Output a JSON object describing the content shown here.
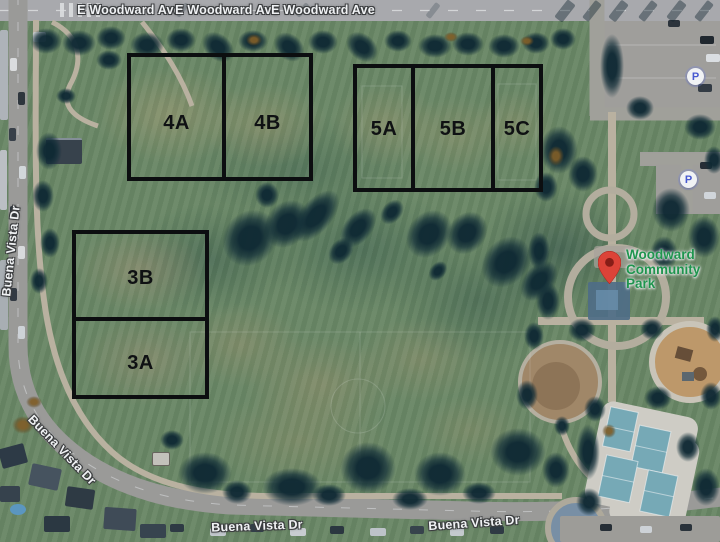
{
  "map": {
    "description": "Satellite map of Woodward Community Park with labeled sports fields"
  },
  "streets": {
    "e_woodward": [
      "E Woodward Ave",
      "E Woodward Ave",
      "E Woodward Ave"
    ],
    "buena_vista": [
      "Buena Vista Dr",
      "Buena Vista Dr",
      "Buena Vista Dr",
      "Buena Vista Dr"
    ]
  },
  "fields": {
    "group4": [
      "4A",
      "4B"
    ],
    "group5": [
      "5A",
      "5B",
      "5C"
    ],
    "group3": [
      "3B",
      "3A"
    ]
  },
  "poi": {
    "line1": "Woodward",
    "line2": "Community Park"
  },
  "icons": {
    "parking": [
      "P",
      "P"
    ]
  },
  "colors": {
    "poi_green": "#1f9b4d",
    "pin_red": "#ea4335",
    "pin_inner": "#8f1a12",
    "parking_blue": "#4a5bd9",
    "field_outline": "#0a0a0a",
    "street_text": "#ffffff"
  }
}
